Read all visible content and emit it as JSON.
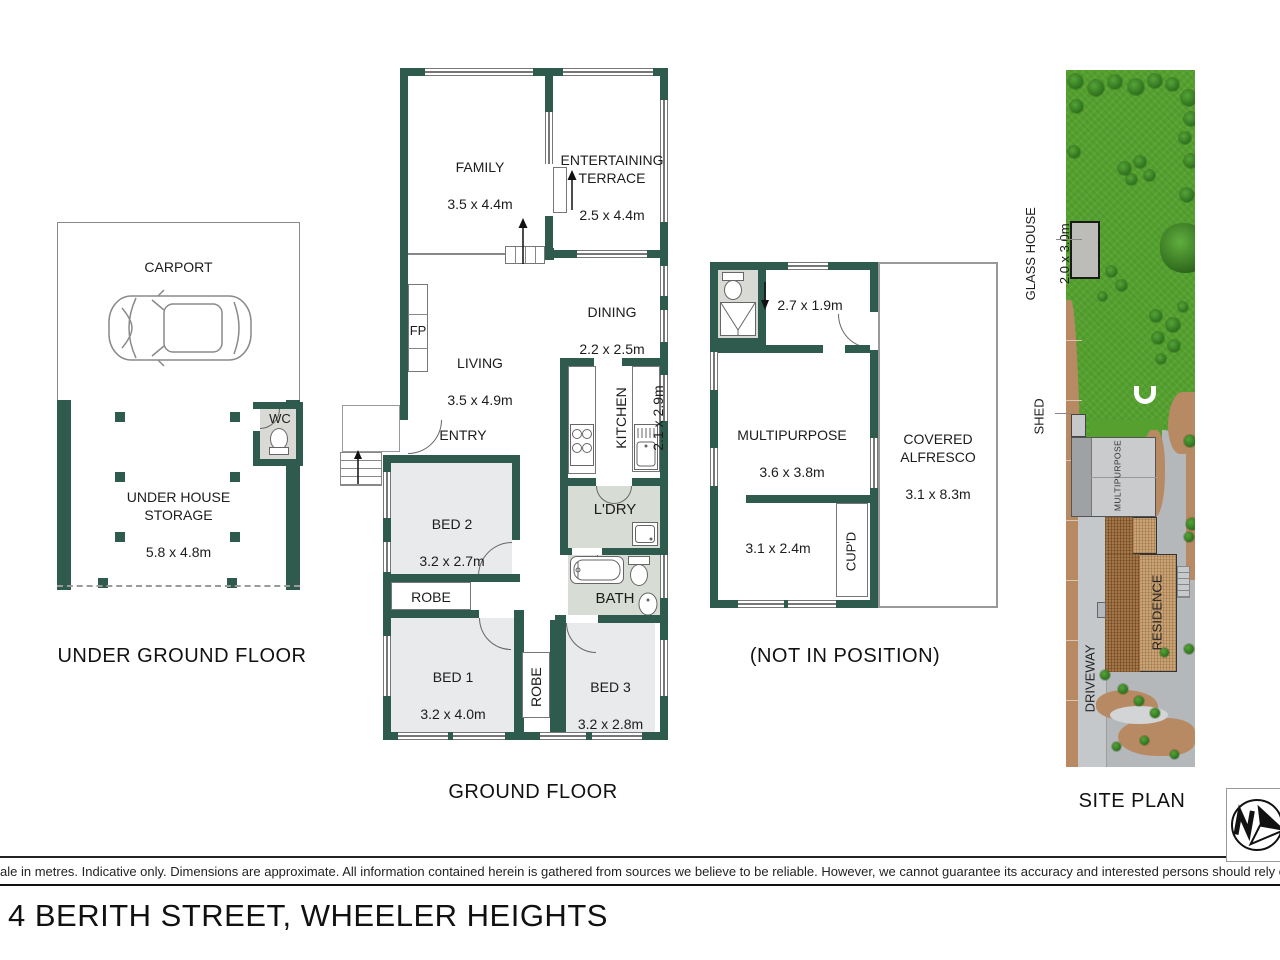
{
  "address": "4 BERITH STREET, WHEELER HEIGHTS",
  "disclaimer": "ale in metres. Indicative only. Dimensions are approximate. All information contained herein is gathered from sources we believe to be reliable. However, we cannot guarantee its accuracy and interested persons should rely on their own enquiries",
  "colors": {
    "wall": "#2e5b4d",
    "lawn": "#55a02f",
    "dirt": "#b78a63",
    "paving": "#b4b8bb"
  },
  "underground": {
    "title": "UNDER GROUND FLOOR",
    "carport_name": "CARPORT",
    "carport_dims": "5.8 x 4.4m",
    "storage_name": "UNDER HOUSE\nSTORAGE",
    "storage_dims": "5.8 x 4.8m",
    "wc": "WC"
  },
  "ground": {
    "title": "GROUND FLOOR",
    "family_name": "FAMILY",
    "family_dims": "3.5 x 4.4m",
    "terrace_name": "ENTERTAINING\nTERRACE",
    "terrace_dims": "2.5 x 4.4m",
    "dining_name": "DINING",
    "dining_dims": "2.2 x 2.5m",
    "living_name": "LIVING",
    "living_dims": "3.5 x 4.9m",
    "kitchen_name": "KITCHEN",
    "kitchen_dims": "2.1 x 2.9m",
    "entry": "ENTRY",
    "fp": "FP",
    "bed2_name": "BED 2",
    "bed2_dims": "3.2 x 2.7m",
    "robe": "ROBE",
    "bed1_name": "BED 1",
    "bed1_dims": "3.2 x 4.0m",
    "bed3_name": "BED 3",
    "bed3_dims": "3.2 x 2.8m",
    "robe2": "ROBE",
    "ldry": "L'DRY",
    "bath": "BATH"
  },
  "annex": {
    "title": "(NOT IN POSITION)",
    "wc_dims": "2.7 x 1.9m",
    "multi_name": "MULTIPURPOSE",
    "multi_dims": "3.6 x 3.8m",
    "alfresco_name": "COVERED\nALFRESCO",
    "alfresco_dims": "3.1 x 8.3m",
    "store_dims": "3.1 x 2.4m",
    "cupd": "CUP'D"
  },
  "site": {
    "title": "SITE PLAN",
    "glasshouse_name": "GLASS HOUSE",
    "glasshouse_dims": "2.0 x 3.0m",
    "shed": "SHED",
    "multipurpose": "MULTIPURPOSE",
    "residence": "RESIDENCE",
    "driveway": "DRIVEWAY"
  }
}
